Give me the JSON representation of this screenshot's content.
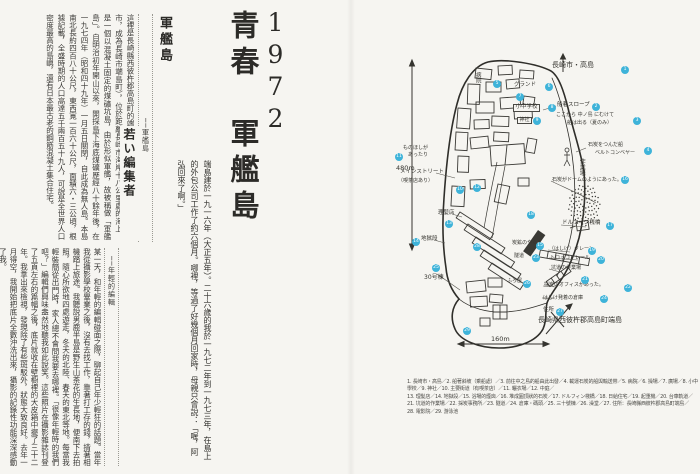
{
  "colors": {
    "paper": "#f6f5f1",
    "ink": "#2c2b28",
    "marker_blue": "#3eb3d9",
    "rule_dotted": "#9a9992"
  },
  "left_page": {
    "title_year": "1972",
    "title": "青春　軍艦島",
    "section1": {
      "header": "軍艦島",
      "attribution": "──軍艦島",
      "quote": "這裡是長崎縣西彼杵郡高島町的端島（二〇〇五年一月四日編入長崎市，成為長崎市端島町），位於距離長崎市海岸十八公里處的海上，是一個以混凝土固定的煤礦坑島，由於形似軍艦，故被稱做「軍艦島」。自明治初年開山以來，開採島下海底煤礦歷經八十餘年後，在一九七四年（昭和四十九年）一月五日關閉，自此成為無人島。本島南北長約四百八十公尺，東西寬一百六十公尺，面積六・三公頃，根據記載，全盛時期的人口高達五千兩百五十九人，可說是全世界人口密度最高的島嶼，還有日本最古老的鋼筋混凝土集合住宅。",
      "body": "端島建於一九一六年（大正五年）。二十六歲的我於一九七二年到一九七三年，在島上的外包公司工作了約六個月。哪裡，等過了好幾個月回家時，母親只會說：「喔，阿弘回來了啊。」"
    },
    "section2": {
      "header": "若い編集者",
      "attribution": "──年輕的編輯",
      "body": "某一天，和年輕的編輯碰面之際，聊起自己年少輕狂的話題。當年我從攝影學校畢業之後，沒有去找工作，靠著打工存的錢，揹著相機踏上旅途。我聽說男鹿半島是野生山茶花的生長地，便南下去拍照，隨心所欲地四處遊走，冬天的北陸、春天的東北等地。每當我輕裝簡從出門時，家人總不會問我要去哪裡。「很像年輕時的我們吧？」編輯們興味盎然地聽我如此說笑。這些照片在攝影雜誌刊登了五頁左右的篇幅之後，底片就收在壁櫥裡的大皮箱中擺了三十二年。我拿出來檢視，發現除了有些斑駁外，狀態大致良好。去年一月得空，我開始把底片全數沖洗出來，攝影的記錄性功能深深感動了我。"
    }
  },
  "map": {
    "scale_v": "480m",
    "scale_h": "160m",
    "labels": [
      {
        "text": "長崎市・高島",
        "x": 552,
        "y": 62,
        "s": 7
      },
      {
        "text": "船着スロープ",
        "x": 557,
        "y": 103,
        "s": 5.5
      },
      {
        "text": "ここから 中ノ島 にむけて",
        "x": 556,
        "y": 113,
        "s": 5
      },
      {
        "text": "船は出る（夏のみ）",
        "x": 567,
        "y": 121,
        "s": 5
      },
      {
        "text": "石炭をつんだ船",
        "x": 588,
        "y": 143,
        "s": 5
      },
      {
        "text": "ベルトコンベヤー",
        "x": 595,
        "y": 151,
        "s": 5
      },
      {
        "text": "病院",
        "x": 474,
        "y": 72,
        "s": 5.5,
        "vert": true
      },
      {
        "text": "グランド",
        "x": 514,
        "y": 83,
        "s": 5.5
      },
      {
        "text": "小中学校",
        "x": 513,
        "y": 104,
        "s": 5.5,
        "box": true
      },
      {
        "text": "神社",
        "x": 517,
        "y": 117,
        "s": 5,
        "box": true
      },
      {
        "text": "ものほしが",
        "x": 403,
        "y": 146,
        "s": 5
      },
      {
        "text": "あったり",
        "x": 408,
        "y": 153,
        "s": 5
      },
      {
        "text": "メインストリート",
        "x": 400,
        "y": 170,
        "s": 5.5
      },
      {
        "text": "（喫茶店あり）",
        "x": 398,
        "y": 179,
        "s": 5
      },
      {
        "text": "理髪店",
        "x": 438,
        "y": 211,
        "s": 5.5
      },
      {
        "text": "地獄段",
        "x": 421,
        "y": 237,
        "s": 5.5
      },
      {
        "text": "炭鉱のやぐら",
        "x": 512,
        "y": 241,
        "s": 5
      },
      {
        "text": "隧道",
        "x": 514,
        "y": 254,
        "s": 5
      },
      {
        "text": "ふろ屋",
        "x": 507,
        "y": 279,
        "s": 5
      },
      {
        "text": "30号棟",
        "x": 424,
        "y": 275,
        "s": 6
      },
      {
        "text": "作業場",
        "x": 578,
        "y": 158,
        "s": 6,
        "vert": true
      },
      {
        "text": "石炭がドームのようにあった。",
        "x": 552,
        "y": 178,
        "s": 5
      },
      {
        "text": "ドルフィン桟橋",
        "x": 562,
        "y": 221,
        "s": 5.5
      },
      {
        "text": "（はしけ）クレーン",
        "x": 549,
        "y": 247,
        "s": 5
      },
      {
        "text": "トロッコ・レール",
        "x": 550,
        "y": 256,
        "s": 5
      },
      {
        "text": "坑道の作業場",
        "x": 551,
        "y": 266,
        "s": 5
      },
      {
        "text": "採炭のオフィスがあった。",
        "x": 544,
        "y": 283,
        "s": 5
      },
      {
        "text": "はしけ発着の倉庫",
        "x": 543,
        "y": 296,
        "s": 5
      },
      {
        "text": "住所",
        "x": 543,
        "y": 308,
        "s": 5.5
      },
      {
        "text": "長崎県西彼杵郡高島町端島",
        "x": 538,
        "y": 317,
        "s": 7
      }
    ],
    "dots": [
      {
        "n": "1",
        "x": 625,
        "y": 70
      },
      {
        "n": "2",
        "x": 596,
        "y": 107
      },
      {
        "n": "3",
        "x": 637,
        "y": 121
      },
      {
        "n": "4",
        "x": 648,
        "y": 151
      },
      {
        "n": "5",
        "x": 497,
        "y": 84
      },
      {
        "n": "6",
        "x": 549,
        "y": 87
      },
      {
        "n": "7",
        "x": 520,
        "y": 97
      },
      {
        "n": "8",
        "x": 552,
        "y": 108
      },
      {
        "n": "9",
        "x": 537,
        "y": 121
      },
      {
        "n": "10",
        "x": 460,
        "y": 190
      },
      {
        "n": "11",
        "x": 399,
        "y": 157
      },
      {
        "n": "12",
        "x": 477,
        "y": 188
      },
      {
        "n": "13",
        "x": 449,
        "y": 224
      },
      {
        "n": "14",
        "x": 416,
        "y": 242
      },
      {
        "n": "15",
        "x": 540,
        "y": 246
      },
      {
        "n": "16",
        "x": 625,
        "y": 180
      },
      {
        "n": "17",
        "x": 610,
        "y": 226
      },
      {
        "n": "18",
        "x": 531,
        "y": 215
      },
      {
        "n": "19",
        "x": 592,
        "y": 251
      },
      {
        "n": "20",
        "x": 601,
        "y": 260
      },
      {
        "n": "21",
        "x": 585,
        "y": 280
      },
      {
        "n": "22",
        "x": 628,
        "y": 288
      },
      {
        "n": "23",
        "x": 536,
        "y": 258
      },
      {
        "n": "24",
        "x": 604,
        "y": 299
      },
      {
        "n": "25",
        "x": 436,
        "y": 268
      },
      {
        "n": "26",
        "x": 527,
        "y": 284
      },
      {
        "n": "27",
        "x": 560,
        "y": 312
      },
      {
        "n": "28",
        "x": 477,
        "y": 247
      },
      {
        "n": "29",
        "x": 467,
        "y": 331
      }
    ]
  },
  "legend": {
    "lines": [
      "1. 長崎市・高島／2. 船著斜坡（乘船處）／3. 前往中之島的船由此出發／4. 載運石炭的船與輸送帶／5. 病院／6. 操場／7. 廣場／8. 小中學校／9. 神社／10. 主要街道（有喫茶店）／11. 曬衣場／12. 中庭／",
      "13. 理髮店／14. 地獄段／15. 浴場的煙囪／16. 堆成圓頂狀的石炭／17. ドルフィン棧橋／18. 日給住宅／19. 起重機／20. 台車軌道／",
      "21. 坑道的作業場／22. 採炭事務所／23. 隧道／24. 倉庫・碼頭／25. 三十號棟／26. 澡堂／27. 住所：長崎縣西彼杵郡高島町端島／",
      "28. 電影院／29. 游泳池"
    ]
  }
}
